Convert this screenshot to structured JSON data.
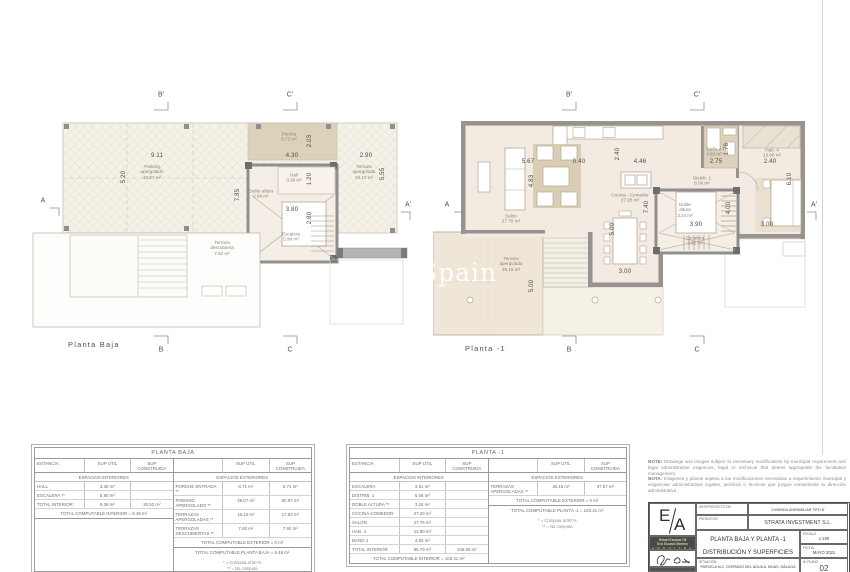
{
  "watermark": "Spain",
  "plans": [
    {
      "caption": "Planta  Baja",
      "markers": [
        {
          "t": "B'",
          "x": 131,
          "y": 13
        },
        {
          "t": "C'",
          "x": 260,
          "y": 13
        },
        {
          "t": "A",
          "x": 13,
          "y": 119
        },
        {
          "t": "A'",
          "x": 378,
          "y": 123
        },
        {
          "t": "B",
          "x": 131,
          "y": 268
        },
        {
          "t": "C",
          "x": 260,
          "y": 268
        }
      ],
      "rooms": [
        {
          "n": "Porche",
          "a": "8.71 m²",
          "x": 259,
          "y": 55
        },
        {
          "n": "Parking",
          "a2": "apergolado",
          "a": "48.07 m²",
          "x": 122,
          "y": 90
        },
        {
          "n": "Terraza",
          "a2": "apergolada",
          "a": "16.10 m²",
          "x": 334,
          "y": 90
        },
        {
          "n": "Hall",
          "a": "3.36 m²",
          "x": 264,
          "y": 96
        },
        {
          "n": "Doble altura",
          "a": "2.94 m²",
          "x": 231,
          "y": 112
        },
        {
          "n": "Escalera",
          "a": "5.90 m²",
          "x": 261,
          "y": 155
        },
        {
          "n": "Terraza",
          "a2": "descubierta",
          "a": "7.92 m²",
          "x": 192,
          "y": 166
        }
      ],
      "dims": [
        {
          "t": "9.11",
          "x": 127,
          "y": 74
        },
        {
          "t": "4.30",
          "x": 262,
          "y": 74
        },
        {
          "t": "2.90",
          "x": 336,
          "y": 74
        },
        {
          "t": "5.20",
          "x": 94,
          "y": 95,
          "r": 1
        },
        {
          "t": "2.03",
          "x": 280,
          "y": 59,
          "r": 1
        },
        {
          "t": "1.20",
          "x": 280,
          "y": 97,
          "r": 1
        },
        {
          "t": "3.80",
          "x": 262,
          "y": 128
        },
        {
          "t": "2.80",
          "x": 280,
          "y": 136,
          "r": 1
        },
        {
          "t": "7.85",
          "x": 208,
          "y": 113,
          "r": 1
        },
        {
          "t": "5.55",
          "x": 353,
          "y": 92,
          "r": 1
        }
      ]
    },
    {
      "caption": "Planta  -1",
      "markers": [
        {
          "t": "B'",
          "x": 136,
          "y": 13
        },
        {
          "t": "C'",
          "x": 264,
          "y": 13
        },
        {
          "t": "A",
          "x": 14,
          "y": 123
        },
        {
          "t": "A'",
          "x": 381,
          "y": 123
        },
        {
          "t": "B",
          "x": 136,
          "y": 268
        },
        {
          "t": "C",
          "x": 264,
          "y": 268
        }
      ],
      "rooms": [
        {
          "n": "Salón",
          "a": "27.76 m²",
          "x": 78,
          "y": 137
        },
        {
          "n": "Cocina - Comedor",
          "a": "27.28 m²",
          "x": 197,
          "y": 116
        },
        {
          "n": "Baño 4",
          "a": "4.83 m²",
          "x": 281,
          "y": 70
        },
        {
          "n": "Hab. 4",
          "a": "13.90 m²",
          "x": 339,
          "y": 71
        },
        {
          "n": "Distrib. 1",
          "a": "6.06 m²",
          "x": 269,
          "y": 99
        },
        {
          "n": "Doble",
          "a2": "altura",
          "a": "3.24 m²",
          "x": 252,
          "y": 128
        },
        {
          "n": "Escalera",
          "a": "3.91 m²",
          "x": 262,
          "y": 159
        },
        {
          "n": "Terraza",
          "a2": "apergolada",
          "a": "36.15 m²",
          "x": 78,
          "y": 182
        }
      ],
      "dims": [
        {
          "t": "5.67",
          "x": 95,
          "y": 80
        },
        {
          "t": "0.40",
          "x": 146,
          "y": 80
        },
        {
          "t": "2.40",
          "x": 185,
          "y": 72,
          "r": 1
        },
        {
          "t": "4.46",
          "x": 207,
          "y": 80
        },
        {
          "t": "2.75",
          "x": 283,
          "y": 80
        },
        {
          "t": "1.76",
          "x": 294,
          "y": 67,
          "r": 1
        },
        {
          "t": "2.40",
          "x": 337,
          "y": 80
        },
        {
          "t": "4.83",
          "x": 99,
          "y": 99,
          "r": 1
        },
        {
          "t": "6.10",
          "x": 357,
          "y": 97,
          "r": 1
        },
        {
          "t": "7.40",
          "x": 214,
          "y": 125,
          "r": 1
        },
        {
          "t": "4.00",
          "x": 296,
          "y": 126,
          "r": 1
        },
        {
          "t": "3.90",
          "x": 263,
          "y": 143
        },
        {
          "t": "3.00",
          "x": 334,
          "y": 143
        },
        {
          "t": "5.00",
          "x": 180,
          "y": 147,
          "r": 1
        },
        {
          "t": "3.00",
          "x": 192,
          "y": 190
        },
        {
          "t": "5.00",
          "x": 99,
          "y": 204,
          "r": 1
        }
      ]
    }
  ],
  "tables": [
    {
      "title": "PLANTA BAJA",
      "col_estancia": "ESTANCIA",
      "col_util": "SUP ÚTIL",
      "col_constr": "SUP CONSTRUIDA",
      "interior_header": "ESPACIOS INTERIORES",
      "exterior_header": "ESPACIOS EXTERIORES",
      "interior_rows": [
        [
          "HALL",
          "3.36 m²",
          ""
        ],
        [
          "ESCALERA **",
          "5.90 m²",
          ""
        ],
        [
          "TOTAL INTERIOR",
          "9.26 m²",
          "20.52 m²"
        ]
      ],
      "interior_total": "TOTAL COMPUTABLE INTERIOR = 8.48 m²",
      "exterior_rows": [
        [
          "PORCHE ENTRADA **",
          "8.71 m²",
          "8.71 m²"
        ],
        [
          "PARKING APERGOLADO **",
          "48.07 m²",
          "50.97 m²"
        ],
        [
          "TERRAZAS APERGOLADAS **",
          "16.10 m²",
          "17.83 m²"
        ],
        [
          "TERRAZAS DESCUBIERTAS **",
          "7.92 m²",
          "7.92 m²"
        ]
      ],
      "exterior_total": "TOTAL COMPUTABLE EXTERIOR = 0 m²",
      "grand_total": "TOTAL COMPUTABLE PLANTA BAJA = 8.48 m²",
      "footnote1": "* = Computa al 50 %",
      "footnote2": "** = No computa"
    },
    {
      "title": "PLANTA  -1",
      "col_estancia": "ESTANCIA",
      "col_util": "SUP ÚTIL",
      "col_constr": "SUP CONSTRUIDA",
      "interior_header": "ESPACIOS INTERIORES",
      "exterior_header": "ESPACIOS EXTERIORES",
      "interior_rows": [
        [
          "ESCALERA",
          "3.91 m²",
          ""
        ],
        [
          "DISTRIB. 1",
          "6.06 m²",
          ""
        ],
        [
          "DOBLE ALTURA **",
          "3.24 m²",
          ""
        ],
        [
          "COCINA-COMEDOR",
          "27.28 m²",
          ""
        ],
        [
          "SALÓN",
          "27.76 m²",
          ""
        ],
        [
          "HAB. 4",
          "13.90 m²",
          ""
        ],
        [
          "BAÑO 4",
          "4.83 m²",
          ""
        ],
        [
          "TOTAL INTERIOR",
          "85.79 m²",
          "106.65 m²"
        ]
      ],
      "interior_total": "TOTAL COMPUTABLE INTERIOR = 103.41 m²",
      "exterior_rows": [
        [
          "TERRAZAS APERGOLADAS **",
          "36.15 m²",
          "37.57 m²"
        ]
      ],
      "exterior_total": "TOTAL COMPUTABLE EXTERIOR = 0 m²",
      "grand_total": "TOTAL COMPUTABLE PLANTA  -1 = 103.41 m²",
      "footnote1": "* = Computa al 50 %",
      "footnote2": "** = No computa"
    }
  ],
  "notes": {
    "en_label": "NOTE:",
    "en": " Drawings and images subject to necessary modifications by municipal requirement and legal administrative exigences, legal or technical that deems appropriate the facultative management",
    "es_label": "NOTA:",
    "es": " Imágenes y planos sujetos a las modificaciones necesarias a requerimiento municipal y exigencias administrativas legales, jurídicas o técnicas que juzgue conveniente la dirección administrativa"
  },
  "titleblock": {
    "logo_e": "E",
    "logo_a": "A",
    "firm_line1": "Rafael Escassi Gil",
    "firm_line2": "Eva Escassi Moreno",
    "firm_line3": "A R Q U I T E C T O S",
    "anteproyecto_label": "ANTEPROYECTO DE:",
    "anteproyecto_value": "VIVIENDA UNIFAMILIAR TIPO B'",
    "promotor_label": "PROMOTOR:",
    "promotor_value": "STRATA INVESTMENT S.L.",
    "title_line1": "PLANTA BAJA Y PLANTA -1",
    "title_line2": "DISTRIBUCIÓN Y SUPERFICIES",
    "escala_label": "ESCALA:",
    "escala_value": "1:100",
    "fecha_label": "FECHA:",
    "fecha_value": "MAYO 2021",
    "situacion_label": "SITUACIÓN:",
    "situacion_value": "PARCELA M-2, CERRADO DEL ÁGUILA, MIJAS, MÁLAGA",
    "plano_label": "Nº PLANO:",
    "plano_value": "02"
  }
}
